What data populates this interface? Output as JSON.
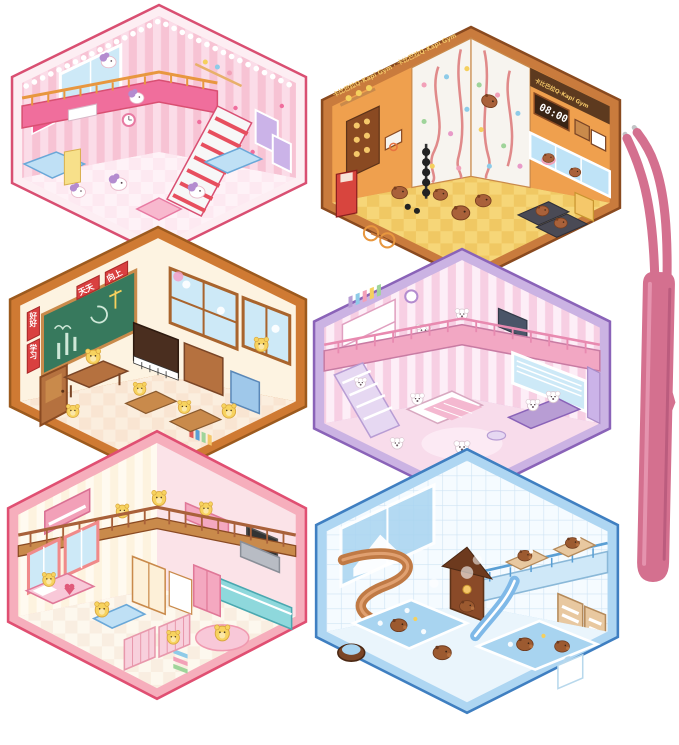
{
  "canvas": {
    "background": "#ffffff",
    "description": "Six hexagonal 3D miniature sticker dollhouse rooms arranged in a honeycomb with a pair of pink tweezers on the right"
  },
  "rooms": [
    {
      "id": "pony-bedroom",
      "name": "pink pony loft bedroom",
      "species": "pony",
      "colors": {
        "outline": "#d94f72",
        "border": "#fdeef3",
        "wall": "#f7c3d4",
        "stripe": "#fbdce8",
        "floor": "#fde9f1",
        "checker": "#fff6fa",
        "loft": "#f06e9c",
        "railing": "#e8973f",
        "stair": "#e74f5e",
        "window": "#cde9f7",
        "vanity": "#bfe0f5",
        "frame": "#ef5d8f"
      }
    },
    {
      "id": "capybara-gym",
      "name": "capybara climbing gym",
      "species": "capybara",
      "banner": "卡比巴拉Q-Kapi Gym",
      "banner_repeat": "卡比巴拉Q-Kapi Gym · 卡比巴拉Q-Kapi Gym",
      "clock": "08:00",
      "colors": {
        "outline": "#8a4a1f",
        "border": "#c97b3d",
        "wall": "#efa04e",
        "climb": "#f7f4ef",
        "rope": "#e08a8a",
        "floor": "#f6d678",
        "checker": "#eec25a",
        "banner_bg": "#5d3a1f",
        "banner_text": "#f3c769",
        "clock_bg": "#3a2414",
        "window": "#bfe3f7",
        "machine": "#4a4a55",
        "capy": "#a9613a"
      }
    },
    {
      "id": "bear-classroom",
      "name": "yellow bear classroom",
      "species": "bear",
      "signs": {
        "top1": "天天",
        "top2": "向上",
        "side1": "好好",
        "side2": "学习"
      },
      "colors": {
        "outline": "#9c5a1e",
        "border": "#cf7a33",
        "wall": "#fdf3e1",
        "floor": "#fbeede",
        "checker": "#f8ddc9",
        "board": "#37795d",
        "plaque": "#d94040",
        "wood": "#b5713f",
        "window": "#cde9f7",
        "cabinet": "#9fc8ea",
        "bear": "#f7d35f"
      }
    },
    {
      "id": "puppy-bedroom",
      "name": "white puppy loft bedroom",
      "species": "puppy",
      "colors": {
        "outline": "#8a63b8",
        "border": "#cbb3e3",
        "wall": "#f7cfe3",
        "stripe": "#fdeef7",
        "floor": "#f8dceb",
        "loft": "#f2a7c3",
        "rail": "#e88ab0",
        "stairs": "#e6d8f2",
        "sofa": "#b89dd4",
        "window": "#cde9f7",
        "blanket": "#f4b8d0",
        "curtain": "#cbb3e8"
      }
    },
    {
      "id": "bear-house",
      "name": "yellow bear family house",
      "species": "bear",
      "colors": {
        "outline": "#e04f72",
        "border": "#f6aebc",
        "wall": "#fdf3df",
        "stripe": "#fffaf0",
        "floor": "#fdf8ee",
        "checker": "#f6e8d8",
        "railing": "#a9613a",
        "fascia": "#c98a4b",
        "kitchen": "#8ed8dc",
        "hood": "#b8bcc4",
        "bed": "#f8c8d8",
        "window": "#cde9f7",
        "piano": "#f2a0b8",
        "rug": "#f8c8d8"
      }
    },
    {
      "id": "capybara-bathhouse",
      "name": "capybara bath house and water park",
      "species": "capybara",
      "colors": {
        "outline": "#3f7fc1",
        "border": "#aed6f2",
        "wall": "#f5fbff",
        "tile": "#cfe4f4",
        "floor": "#eaf5fc",
        "water": "#a8d4f0",
        "slide": "#c07a45",
        "slide_hi": "#e0a070",
        "blue_slide": "#7fb9e8",
        "deck": "#cfe8f8",
        "wood": "#8a4a28",
        "table": "#e8c8a0",
        "capy": "#9c5a30"
      }
    }
  ],
  "tweezers": {
    "name": "pink curved-tip tweezers",
    "body": "#d4708f",
    "highlight": "#e89ab4",
    "shadow": "#b5587a",
    "tip": "#c3c4c6"
  }
}
